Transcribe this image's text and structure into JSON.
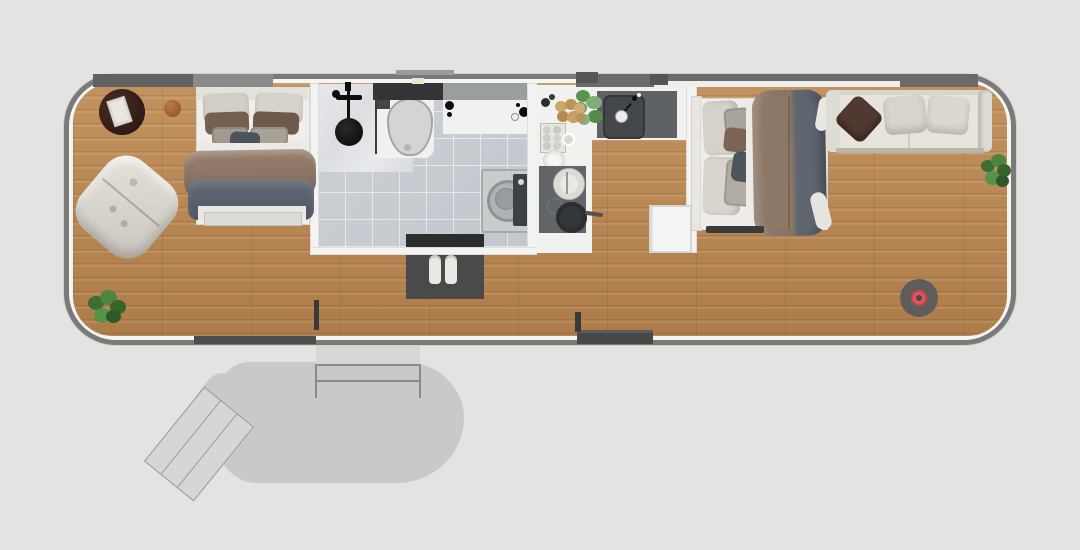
{
  "scene": {
    "description": "Top-down 3D rendered floor plan of a long tiny home / trailer house with two bedrooms, central bathroom and kitchen, living area with sofa, and an exterior entry patio with stairs",
    "background_color": "#e3e3e2"
  },
  "palette": {
    "background": "#e3e3e2",
    "patio_gray": "#c9c9c8",
    "wall_outline": "#7a7a7a",
    "wall_window_band": "#6a6a6a",
    "wood_floor": "#b8885a",
    "tile_floor": "#cbd0d4",
    "counter_white": "#f2f2f0",
    "sink_dark": "#5e6266",
    "bath_mat": "#4a4a4a",
    "duvet_brown": "#8a7262",
    "blanket_gray": "#58616b",
    "sofa_cream": "#e7e4de",
    "pillow_dark_brown": "#503931",
    "plant_green": "#47803a",
    "vacuum_accent": "#e2555e"
  },
  "rooms": [
    {
      "id": "bedroom-left",
      "name": "Left bedroom"
    },
    {
      "id": "bathroom",
      "name": "Bathroom"
    },
    {
      "id": "kitchen",
      "name": "Kitchen"
    },
    {
      "id": "bedroom-right",
      "name": "Right bedroom"
    },
    {
      "id": "living-area",
      "name": "Living area"
    },
    {
      "id": "patio",
      "name": "Entry patio"
    }
  ],
  "labels": {
    "house": "Tiny home unit",
    "side_table": "Round dark side table",
    "book": "Book on side table",
    "wooden_stool": "Small wooden stool",
    "bed_left": "Double bed with gray blanket and brown throw",
    "armchair": "Tufted cream armchair",
    "plant_left": "Potted plant",
    "shower_head": "Black shower fixture",
    "shower_glass": "Shower glass partition",
    "vanity_counter": "Dark vanity counter",
    "toilet": "Toilet",
    "bathroom_counter": "Bathroom counter with taps",
    "washing_machine": "Washing machine",
    "bath_mat": "Dark bath mat",
    "slippers": "Pair of slippers",
    "kitchen_counter": "White kitchen counter",
    "kitchen_sink": "Dark kitchen sink with faucet",
    "herb_plant": "Herb plant",
    "potato_basket": "Basket of potatoes",
    "egg_tray": "Egg tray",
    "plate": "White plate",
    "cooktop": "Cooktop",
    "kettle": "Kettle",
    "frying_pan": "Frying pan",
    "side_cabinet": "Small white cabinet",
    "bed_right": "Double bed with brown and gray duvet",
    "sofa": "Cream sofa",
    "sofa_pillow_brown": "Dark brown throw pillow",
    "sofa_pillow_cream_1": "Cream throw pillow",
    "sofa_pillow_cream_2": "Cream throw pillow",
    "plant_right": "Potted plant",
    "robot_vacuum": "Robot vacuum with red center",
    "patio_deck": "Gray patio deck",
    "entry_platform": "Entry platform",
    "railing": "Entry railing",
    "stairs": "Angled entry stairs",
    "window_top_left": "Top wall window band (left)",
    "window_top_right": "Top wall window band (right)",
    "window_bottom_left": "Bottom wall window (left)",
    "window_bottom_right": "Bottom wall window (right)",
    "door_stub_left": "Door frame stub",
    "door_stub_right": "Door frame stub"
  }
}
